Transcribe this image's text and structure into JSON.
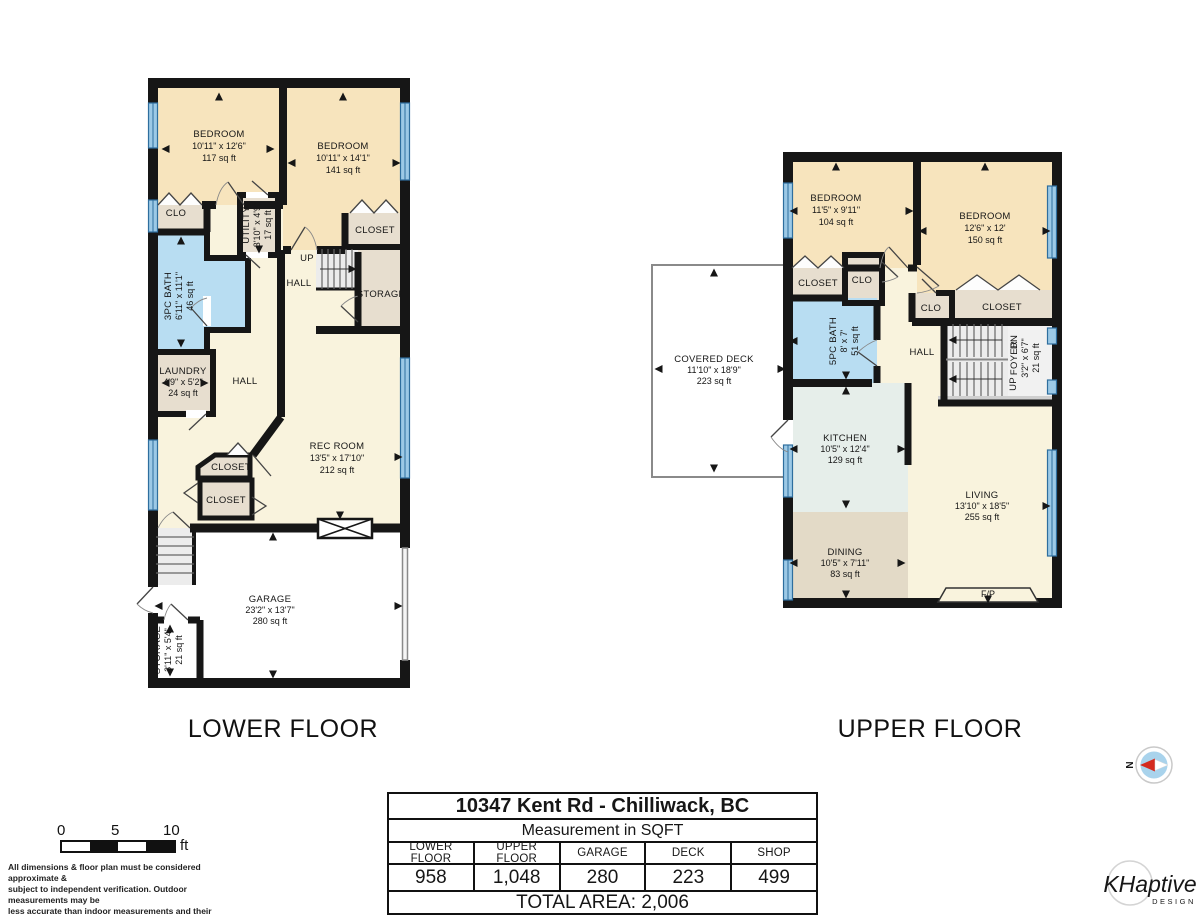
{
  "palette": {
    "wall": "#161616",
    "bedroom_fill": "#f7e4bd",
    "hall_fill": "#f9f3dd",
    "bath_fill": "#b8ddf2",
    "closet_fill": "#e7decf",
    "kitchen_fill": "#e6eeea",
    "dining_fill": "#e3dac7",
    "window_blue": "#9cc9e6",
    "stair_fill": "#ececec",
    "compass_red": "#d42a1e",
    "logo_blue": "#4e7186"
  },
  "lower_floor": {
    "caption": "LOWER FLOOR",
    "rooms": {
      "bedroom1": {
        "name": "BEDROOM",
        "dims": "10'11\" x 12'6\"",
        "area": "117 sq ft"
      },
      "bedroom2": {
        "name": "BEDROOM",
        "dims": "10'11\" x 14'1\"",
        "area": "141 sq ft"
      },
      "clo": {
        "name": "CLO"
      },
      "utility": {
        "name": "UTILITY",
        "dims": "3'10\" x 4'9\"",
        "area": "17 sq ft"
      },
      "closet_a": {
        "name": "CLOSET"
      },
      "storage_a": {
        "name": "STORAGE"
      },
      "up": {
        "name": "UP"
      },
      "hall_a": {
        "name": "HALL"
      },
      "bath": {
        "name": "3PC BATH",
        "dims": "6'11\" x 11'1\"",
        "area": "46 sq ft"
      },
      "laundry": {
        "name": "LAUNDRY",
        "dims": "4'9\" x 5'2\"",
        "area": "24 sq ft"
      },
      "hall_b": {
        "name": "HALL"
      },
      "rec_room": {
        "name": "REC ROOM",
        "dims": "13'5\" x 17'10\"",
        "area": "212 sq ft"
      },
      "closet_b": {
        "name": "CLOSET"
      },
      "closet_c": {
        "name": "CLOSET"
      },
      "garage": {
        "name": "GARAGE",
        "dims": "23'2\" x 13'7\"",
        "area": "280 sq ft"
      },
      "storage_b": {
        "name": "STORAGE",
        "dims": "3'11\" x 5'4\"",
        "area": "21 sq ft"
      }
    }
  },
  "upper_floor": {
    "caption": "UPPER FLOOR",
    "rooms": {
      "bedroom1": {
        "name": "BEDROOM",
        "dims": "11'5\" x 9'11\"",
        "area": "104 sq ft"
      },
      "bedroom2": {
        "name": "BEDROOM",
        "dims": "12'6\" x 12'",
        "area": "150 sq ft"
      },
      "closet_a": {
        "name": "CLOSET"
      },
      "clo_a": {
        "name": "CLO"
      },
      "clo_b": {
        "name": "CLO"
      },
      "closet_b": {
        "name": "CLOSET"
      },
      "bath": {
        "name": "5PC BATH",
        "dims": "8' x 7'",
        "area": "51 sq ft"
      },
      "hall": {
        "name": "HALL"
      },
      "dn": {
        "name": "DN"
      },
      "up": {
        "name": "UP"
      },
      "foyer": {
        "name": "FOYER",
        "dims": "3'2\" x 6'7\"",
        "area": "21 sq ft"
      },
      "kitchen": {
        "name": "KITCHEN",
        "dims": "10'5\" x 12'4\"",
        "area": "129 sq ft"
      },
      "dining": {
        "name": "DINING",
        "dims": "10'5\" x 7'11\"",
        "area": "83 sq ft"
      },
      "living": {
        "name": "LIVING",
        "dims": "13'10\" x 18'5\"",
        "area": "255 sq ft"
      },
      "fireplace": {
        "name": "F/P"
      },
      "deck": {
        "name": "COVERED DECK",
        "dims": "11'10\" x 18'9\"",
        "area": "223 sq ft"
      }
    }
  },
  "title_block": {
    "address": "10347 Kent Rd - Chilliwack, BC",
    "subtitle": "Measurement in SQFT",
    "columns": [
      "LOWER FLOOR",
      "UPPER FLOOR",
      "GARAGE",
      "DECK",
      "SHOP"
    ],
    "values": [
      "958",
      "1,048",
      "280",
      "223",
      "499"
    ],
    "total_label": "TOTAL AREA: 2,006"
  },
  "scale_bar": {
    "tick0": "0",
    "tick5": "5",
    "tick10": "10",
    "unit": "ft"
  },
  "disclaimer": [
    "All dimensions & floor plan must be considered approximate &",
    "subject to independent verification.  Outdoor measurements may be",
    "less accurate than indoor measurements and their accuracy is not",
    "guaranteed."
  ],
  "compass": {
    "north_label": "N"
  },
  "logo": {
    "name": "KHaptive",
    "sub": "DESIGN"
  }
}
